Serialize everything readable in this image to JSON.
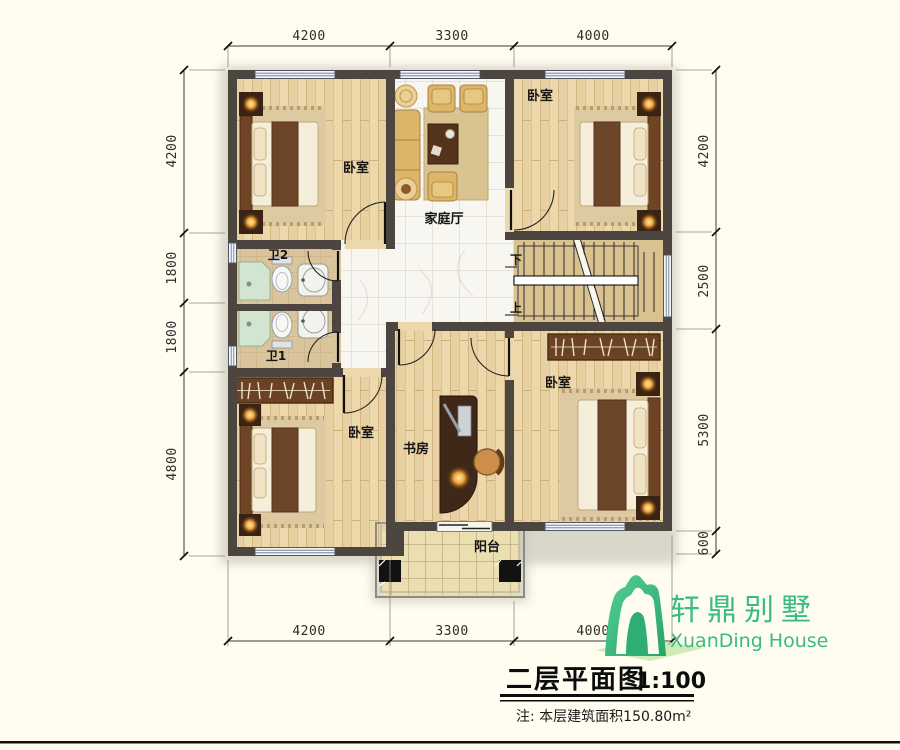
{
  "dimensions": {
    "top": [
      "4200",
      "3300",
      "4000"
    ],
    "bottom": [
      "4200",
      "3300",
      "4000"
    ],
    "left": [
      "4200",
      "1800",
      "1800",
      "4800"
    ],
    "right": [
      "4200",
      "2500",
      "5300",
      "600"
    ]
  },
  "rooms": {
    "bedroom_top_left": "卧室",
    "bedroom_top_right": "卧室",
    "bedroom_bottom_left": "卧室",
    "bedroom_bottom_right": "卧室",
    "family_hall": "家庭厅",
    "bathroom_2": "卫2",
    "bathroom_1": "卫1",
    "study": "书房",
    "balcony": "阳台"
  },
  "stairs": {
    "down": "下",
    "up": "上"
  },
  "title_block": {
    "title": "二层平面图",
    "scale": "1:100",
    "note": "注: 本层建筑面积150.80m²"
  },
  "logo": {
    "name_cn": "轩鼎别墅",
    "name_en": "XuanDing House",
    "color": "#3abc80"
  },
  "colors": {
    "wall": "#4d4640",
    "wood_floor": "#ecd8ab",
    "hall_tile": "#f8f6f0",
    "bath_floor": "#dac49c",
    "stair_floor": "#d9c28f",
    "balcony_floor": "#ebdfb2",
    "logo_green": "#3abc80",
    "background": "#fffdf0"
  }
}
